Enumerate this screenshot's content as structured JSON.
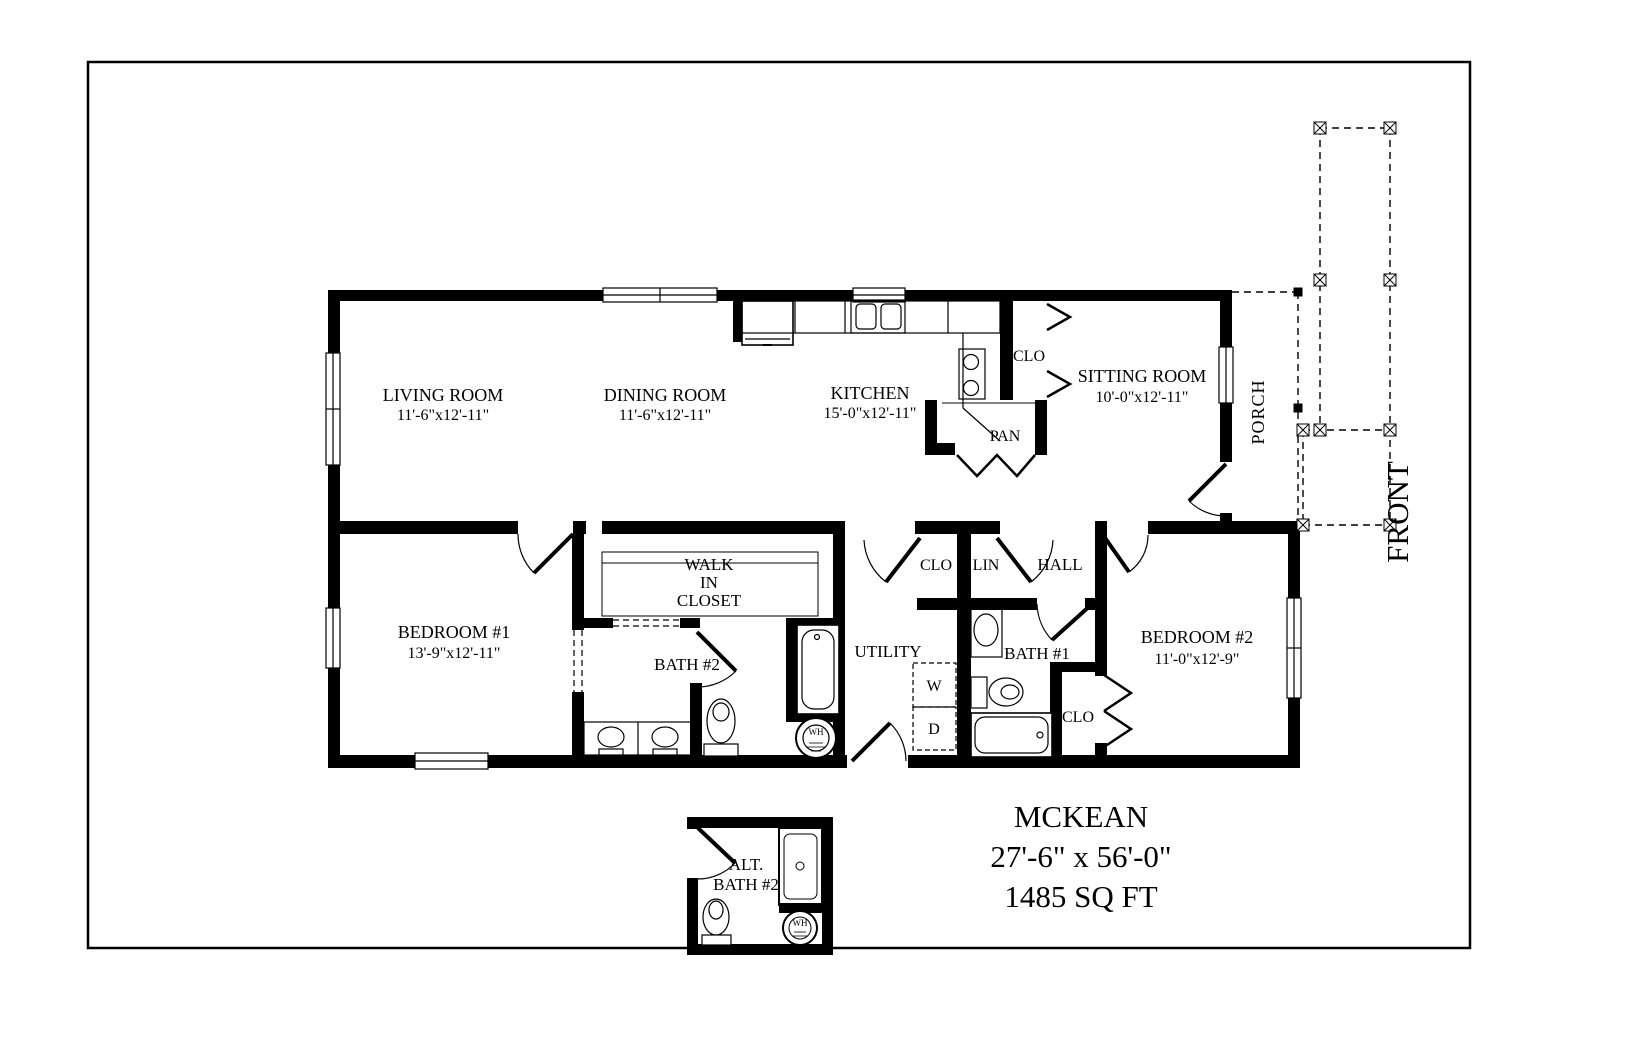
{
  "page": {
    "background": "#ffffff",
    "line_color": "#000000"
  },
  "title_block": {
    "model_name": "MCKEAN",
    "overall_dimensions": "27'-6\" x 56'-0\"",
    "area": "1485 SQ FT"
  },
  "orientation": {
    "front": "FRONT",
    "porch": "PORCH"
  },
  "rooms": {
    "living_room": {
      "name": "LIVING ROOM",
      "dims": "11'-6\"x12'-11\""
    },
    "dining_room": {
      "name": "DINING ROOM",
      "dims": "11'-6\"x12'-11\""
    },
    "kitchen": {
      "name": "KITCHEN",
      "dims": "15'-0\"x12'-11\""
    },
    "sitting_room": {
      "name": "SITTING ROOM",
      "dims": "10'-0\"x12'-11\""
    },
    "bedroom_1": {
      "name": "BEDROOM #1",
      "dims": "13'-9\"x12'-11\""
    },
    "bedroom_2": {
      "name": "BEDROOM #2",
      "dims": "11'-0\"x12'-9\""
    },
    "walk_in_closet": {
      "line1": "WALK",
      "line2": "IN",
      "line3": "CLOSET"
    },
    "bath_1": {
      "name": "BATH #1"
    },
    "bath_2": {
      "name": "BATH #2"
    },
    "alt_bath": {
      "line1": "ALT.",
      "line2": "BATH #2"
    },
    "utility": {
      "name": "UTILITY"
    },
    "hall": {
      "name": "HALL"
    }
  },
  "closets": {
    "kitchen_closet": "CLO",
    "pantry": "PAN",
    "hall_closet": "CLO",
    "linen": "LIN",
    "bedroom2_closet": "CLO"
  },
  "appliances": {
    "washer": "W",
    "dryer": "D",
    "water_heater": "WH",
    "water_heater_alt": "WH"
  }
}
